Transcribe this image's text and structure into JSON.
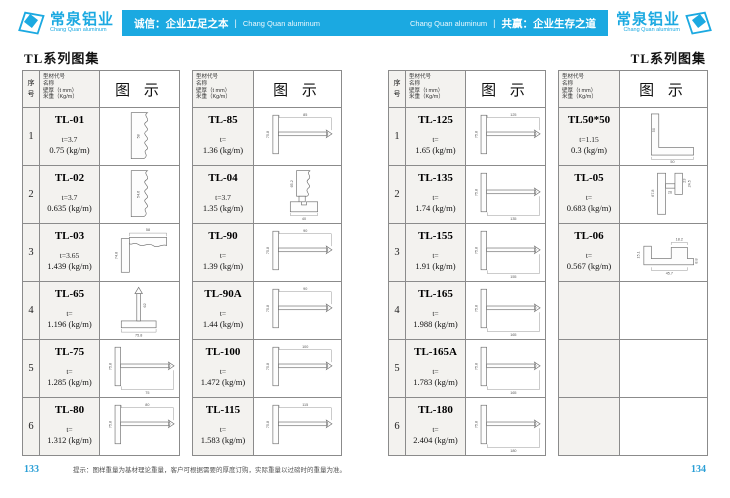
{
  "brand": {
    "name_cn": "常泉铝业",
    "name_en": "Chang Quan aluminum",
    "accent": "#1BA9E1"
  },
  "banner": {
    "left_text": "诚信：企业立足之本",
    "left_sub": "Chang Quan aluminum",
    "right_sub": "Chang Quan aluminum",
    "right_text": "共赢：企业生存之道",
    "divider": "|"
  },
  "table_header": {
    "index_label": "序号",
    "info_lines": [
      "型材代号",
      "名称",
      "壁厚（t mm）",
      "米重（Kg/m）"
    ],
    "diagram_label": "图 示"
  },
  "pages": [
    {
      "title": "TL系列图集",
      "page_number": "133",
      "footer_note": "提示：图样重量为基材理论重量，客户可根据需要的厚度订购，实际重量以过磅时的重量为准。",
      "tables": [
        {
          "has_index": true,
          "empty_rows": 0,
          "rows": [
            {
              "index": "1",
              "code": "TL-01",
              "thickness": "t=3.7",
              "weight": "0.75 (kg/m)",
              "shape": "moldingV",
              "dims": [
                "58"
              ]
            },
            {
              "index": "2",
              "code": "TL-02",
              "thickness": "t=3.7",
              "weight": "0.635 (kg/m)",
              "shape": "moldingV",
              "dims": [
                "54.6"
              ]
            },
            {
              "index": "3",
              "code": "TL-03",
              "thickness": "t=3.65",
              "weight": "1.439 (kg/m)",
              "shape": "cornerL",
              "dims": [
                "58",
                "74.8"
              ]
            },
            {
              "index": "4",
              "code": "TL-65",
              "thickness": "t=",
              "weight": "1.196 (kg/m)",
              "shape": "teeUp",
              "dims": [
                "62",
                "75.8"
              ]
            },
            {
              "index": "5",
              "code": "TL-75",
              "thickness": "t=",
              "weight": "1.285 (kg/m)",
              "shape": "teeRight",
              "dims": [
                "75.8",
                "75"
              ],
              "dim_pos": "bottom"
            },
            {
              "index": "6",
              "code": "TL-80",
              "thickness": "t=",
              "weight": "1.312 (kg/m)",
              "shape": "teeRight",
              "dims": [
                "75.8",
                "80"
              ],
              "dim_pos": "top"
            }
          ]
        },
        {
          "has_index": false,
          "empty_rows": 0,
          "rows": [
            {
              "code": "TL-85",
              "thickness": "t=",
              "weight": "1.36 (kg/m)",
              "shape": "teeRight",
              "dims": [
                "75.8",
                "85"
              ],
              "dim_pos": "top"
            },
            {
              "code": "TL-04",
              "thickness": "t=3.7",
              "weight": "1.35 (kg/m)",
              "shape": "moldingBase",
              "dims": [
                "65.2",
                "40"
              ]
            },
            {
              "code": "TL-90",
              "thickness": "t=",
              "weight": "1.39 (kg/m)",
              "shape": "teeRight",
              "dims": [
                "75.8",
                "90"
              ],
              "dim_pos": "top"
            },
            {
              "code": "TL-90A",
              "thickness": "t=",
              "weight": "1.44 (kg/m)",
              "shape": "teeRight",
              "dims": [
                "75.8",
                "90"
              ],
              "dim_pos": "top"
            },
            {
              "code": "TL-100",
              "thickness": "t=",
              "weight": "1.472 (kg/m)",
              "shape": "teeRight",
              "dims": [
                "75.8",
                "100"
              ],
              "dim_pos": "top"
            },
            {
              "code": "TL-115",
              "thickness": "t=",
              "weight": "1.583 (kg/m)",
              "shape": "teeRight",
              "dims": [
                "75.8",
                "115"
              ],
              "dim_pos": "top"
            }
          ]
        }
      ]
    },
    {
      "title": "TL系列图集",
      "page_number": "134",
      "footer_note": "",
      "tables": [
        {
          "has_index": true,
          "empty_rows": 0,
          "rows": [
            {
              "index": "1",
              "code": "TL-125",
              "thickness": "t=",
              "weight": "1.65 (kg/m)",
              "shape": "teeRight",
              "dims": [
                "75.8",
                "125"
              ],
              "dim_pos": "top"
            },
            {
              "index": "2",
              "code": "TL-135",
              "thickness": "t=",
              "weight": "1.74 (kg/m)",
              "shape": "teeRight",
              "dims": [
                "75.8",
                "135"
              ],
              "dim_pos": "bottom"
            },
            {
              "index": "3",
              "code": "TL-155",
              "thickness": "t=",
              "weight": "1.91 (kg/m)",
              "shape": "teeRight",
              "dims": [
                "75.8",
                "155"
              ],
              "dim_pos": "bottom"
            },
            {
              "index": "4",
              "code": "TL-165",
              "thickness": "t=",
              "weight": "1.988 (kg/m)",
              "shape": "teeRight",
              "dims": [
                "75.8",
                "165"
              ],
              "dim_pos": "bottom"
            },
            {
              "index": "5",
              "code": "TL-165A",
              "thickness": "t=",
              "weight": "1.783 (kg/m)",
              "shape": "teeRight",
              "dims": [
                "75.8",
                "165"
              ],
              "dim_pos": "bottom"
            },
            {
              "index": "6",
              "code": "TL-180",
              "thickness": "t=",
              "weight": "2.404 (kg/m)",
              "shape": "teeRight",
              "dims": [
                "75.8",
                "180"
              ],
              "dim_pos": "bottom"
            }
          ]
        },
        {
          "has_index": false,
          "empty_rows": 3,
          "rows": [
            {
              "code": "TL50*50",
              "thickness": "t=1.15",
              "weight": "0.3 (kg/m)",
              "shape": "angle",
              "dims": [
                "50",
                "50"
              ]
            },
            {
              "code": "TL-05",
              "thickness": "t=",
              "weight": "0.683 (kg/m)",
              "shape": "stepped",
              "dims": [
                "67.8",
                "26",
                "23",
                "24.5"
              ]
            },
            {
              "code": "TL-06",
              "thickness": "t=",
              "weight": "0.567 (kg/m)",
              "shape": "hat",
              "dims": [
                "18.2",
                "15.1",
                "8.8",
                "45.7"
              ]
            }
          ]
        }
      ]
    }
  ]
}
